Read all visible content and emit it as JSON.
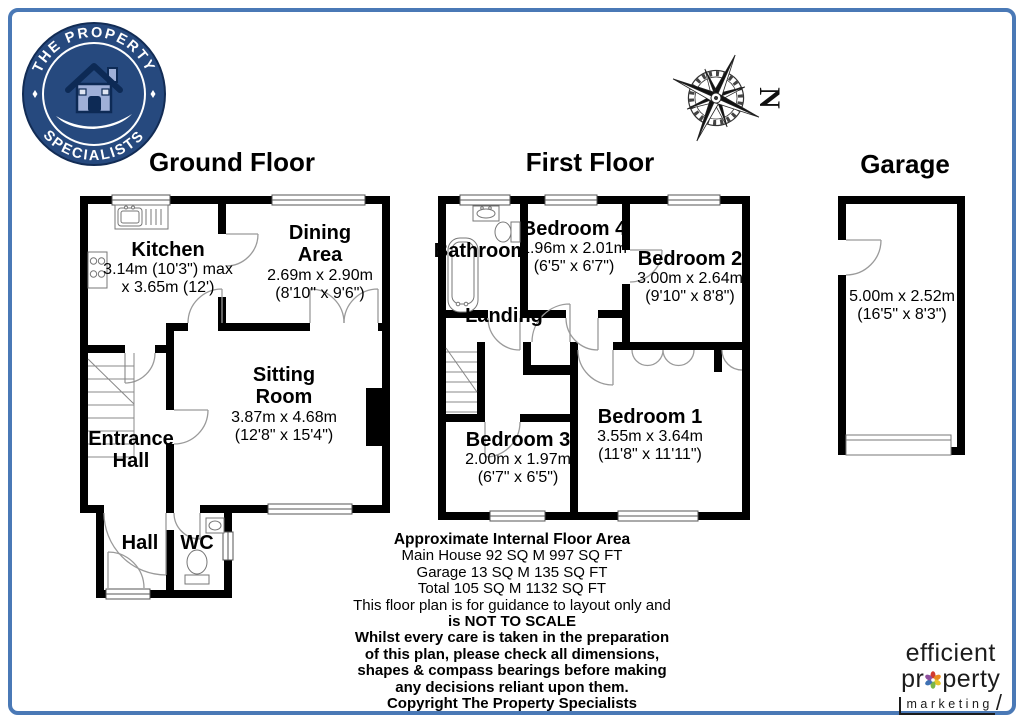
{
  "brand": {
    "name_top": "THE PROPERTY",
    "name_bottom": "SPECIALISTS"
  },
  "compass": {
    "north_label": "N"
  },
  "titles": {
    "ground": "Ground Floor",
    "first": "First Floor",
    "garage": "Garage"
  },
  "rooms": {
    "kitchen": {
      "name": "Kitchen",
      "dims1": "3.14m (10'3\") max",
      "dims2": "x 3.65m (12')"
    },
    "dining": {
      "name1": "Dining",
      "name2": "Area",
      "dims1": "2.69m x 2.90m",
      "dims2": "(8'10\" x 9'6\")"
    },
    "sitting": {
      "name1": "Sitting",
      "name2": "Room",
      "dims1": "3.87m x 4.68m",
      "dims2": "(12'8\" x 15'4\")"
    },
    "entrance": {
      "name1": "Entrance",
      "name2": "Hall"
    },
    "hall": {
      "name": "Hall"
    },
    "wc": {
      "name": "WC"
    },
    "bathroom": {
      "name": "Bathroom"
    },
    "bedroom4": {
      "name": "Bedroom 4",
      "dims1": "1.96m x 2.01m",
      "dims2": "(6'5\" x 6'7\")"
    },
    "bedroom2": {
      "name": "Bedroom 2",
      "dims1": "3.00m x 2.64m",
      "dims2": "(9'10\" x 8'8\")"
    },
    "landing": {
      "name": "Landing"
    },
    "bedroom3": {
      "name": "Bedroom 3",
      "dims1": "2.00m x 1.97m",
      "dims2": "(6'7\" x 6'5\")"
    },
    "bedroom1": {
      "name": "Bedroom 1",
      "dims1": "3.55m x 3.64m",
      "dims2": "(11'8\" x 11'11\")"
    },
    "garage": {
      "dims1": "5.00m x 2.52m",
      "dims2": "(16'5\" x 8'3\")"
    }
  },
  "footer": {
    "lines": [
      "Approximate Internal Floor Area",
      "Main House 92 SQ M 997 SQ FT",
      "Garage 13 SQ M 135 SQ FT",
      "Total 105 SQ M 1132 SQ FT",
      "This floor plan is for guidance to layout only and",
      "is NOT TO SCALE",
      "Whilst every care is taken in the preparation",
      "of this plan, please check all dimensions,",
      "shapes & compass bearings before making",
      "any decisions reliant upon them.",
      "Copyright The Property Specialists"
    ]
  },
  "marketing": {
    "line1": "efficient",
    "line2_prefix": "pr",
    "line2_suffix": "perty",
    "line3": "marketing"
  },
  "colors": {
    "frame_blue": "#4a79b6",
    "logo_blue": "#26497e",
    "wall_black": "#000000"
  }
}
